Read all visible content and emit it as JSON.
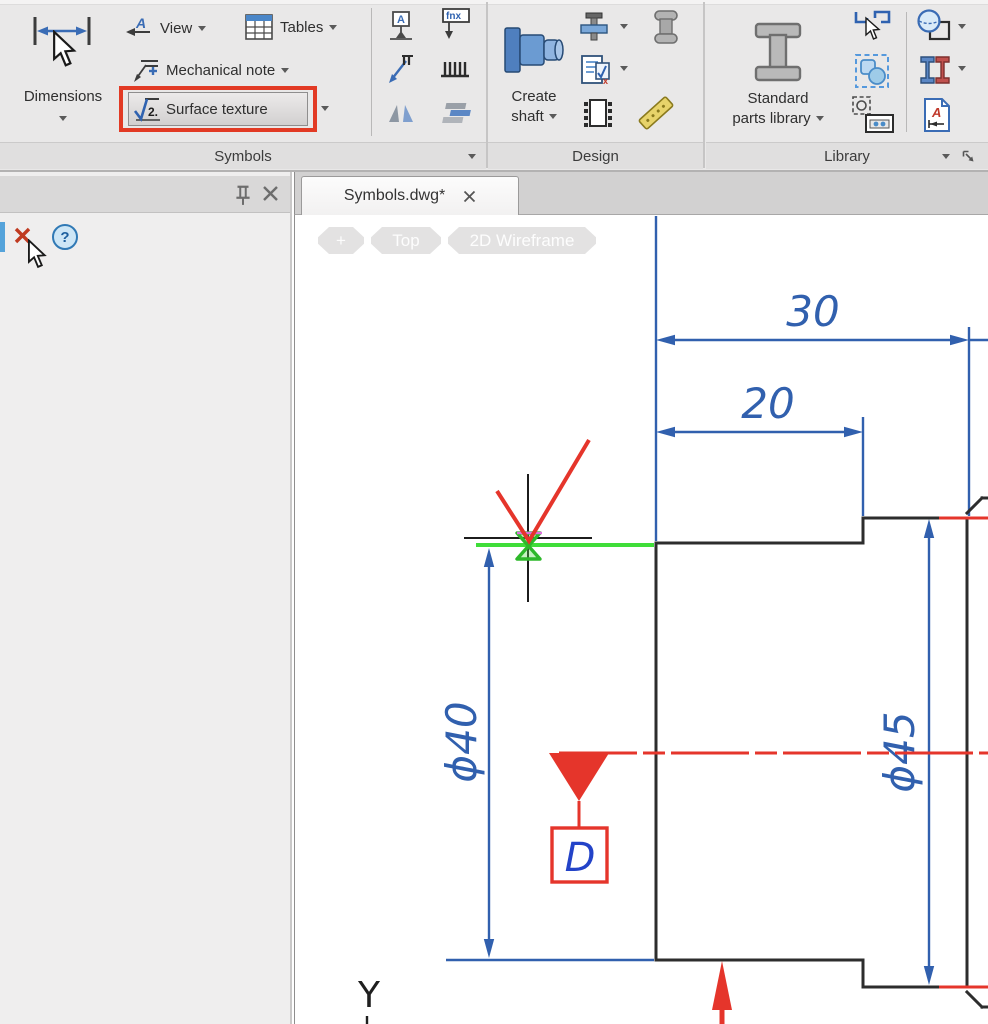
{
  "ribbon": {
    "dimensions": {
      "label": "Dimensions"
    },
    "symbols": {
      "view": "View",
      "tables": "Tables",
      "mechanical_note": "Mechanical note",
      "surface_texture": "Surface texture",
      "panel_label": "Symbols"
    },
    "design": {
      "create_shaft_1": "Create",
      "create_shaft_2": "shaft",
      "panel_label": "Design"
    },
    "library": {
      "std_parts_1": "Standard",
      "std_parts_2": "parts library",
      "panel_label": "Library"
    },
    "icon_glyphs": {
      "view_a": "A",
      "datum_a": "A",
      "fcf": "fnx",
      "surface_texture_number": "2."
    }
  },
  "palette": {
    "help_label": "?"
  },
  "document": {
    "tab_title": "Symbols.dwg*"
  },
  "viewport_controls": {
    "plus": "+",
    "view": "Top",
    "visual_style": "2D Wireframe"
  },
  "drawing": {
    "dim_30": "30",
    "dim_20": "20",
    "dim_phi40": "ϕ40",
    "dim_phi45": "ϕ45",
    "datum_label": "D",
    "ucs_y": "Y"
  },
  "colors": {
    "accent_blue": "#3a6cb5",
    "dimension_blue": "#3160ae",
    "highlight_red": "#e23a24",
    "drawing_red": "#e5352b",
    "selection_green": "#3fdd39"
  }
}
